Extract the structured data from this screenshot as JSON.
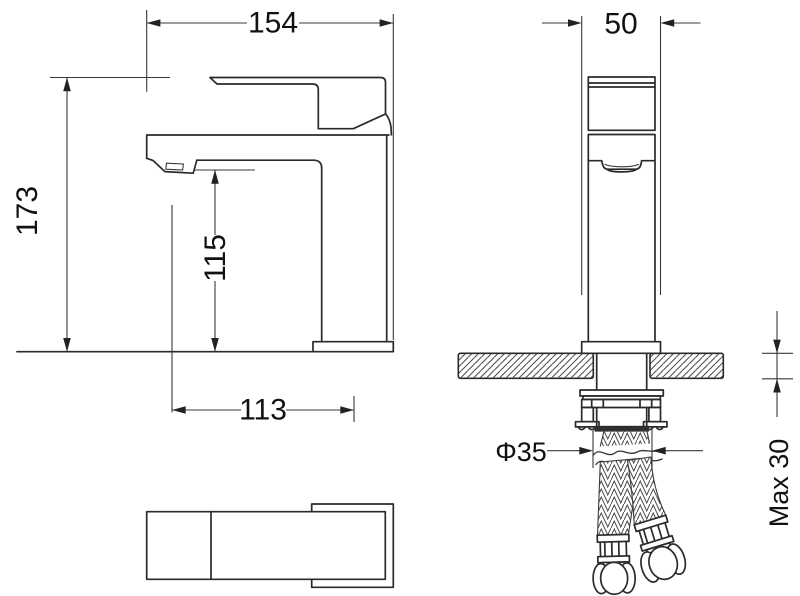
{
  "title": "Basin faucet dimensional drawing",
  "colors": {
    "background": "#ffffff",
    "object_line": "#2a2a2a",
    "dimension_line": "#3a3a3a",
    "text": "#111111"
  },
  "dimensions": {
    "overall_width": "154",
    "overall_height": "173",
    "spout_height": "115",
    "spout_reach": "113",
    "base_width": "50",
    "hole_diameter": "Φ35",
    "max_thickness": "Max 30"
  }
}
